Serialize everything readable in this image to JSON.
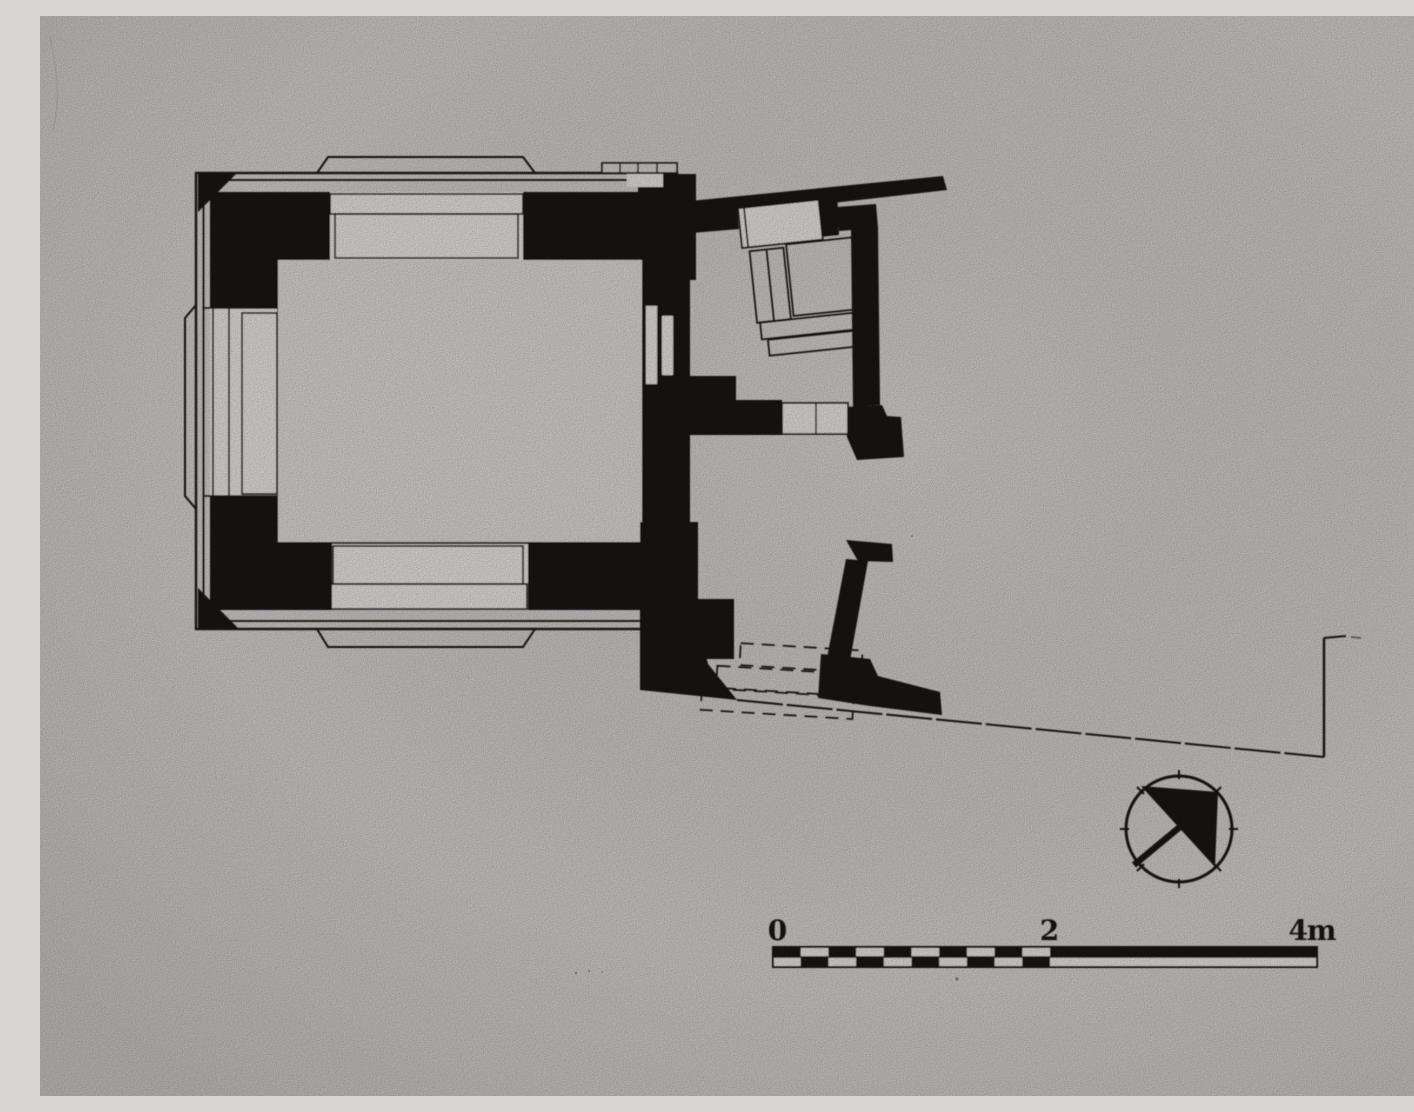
{
  "figure": {
    "description": "Scanned black-and-white architectural floor plan: a square chamber with thick black walls and outlined door openings, an entrance annex with interior stair at upper right, an exterior staircase and retaining wall at lower right, a long boundary line running to the right edge, a north arrow and a metric scale bar.",
    "elements": [
      "main-square-chamber",
      "top-porch-projection",
      "bottom-porch-projection",
      "left-projection",
      "entrance-annex",
      "annex-stair",
      "lower-exterior-stair",
      "boundary-line",
      "north-arrow",
      "scale-bar"
    ]
  },
  "scale_bar": {
    "tick_labels": [
      "0",
      "2",
      "4m"
    ],
    "unit": "m",
    "min": 0,
    "max": 4,
    "major_interval": 2,
    "checker_subdivisions": 10
  },
  "north_arrow": {
    "style": "circle with filled quadrant triangle and needle pointing north-east"
  },
  "colors": {
    "background": "#d8d6d3",
    "ink": "#1b1713",
    "paper_opening": "#eceae6",
    "chamber_fill": "#e0dedb"
  }
}
